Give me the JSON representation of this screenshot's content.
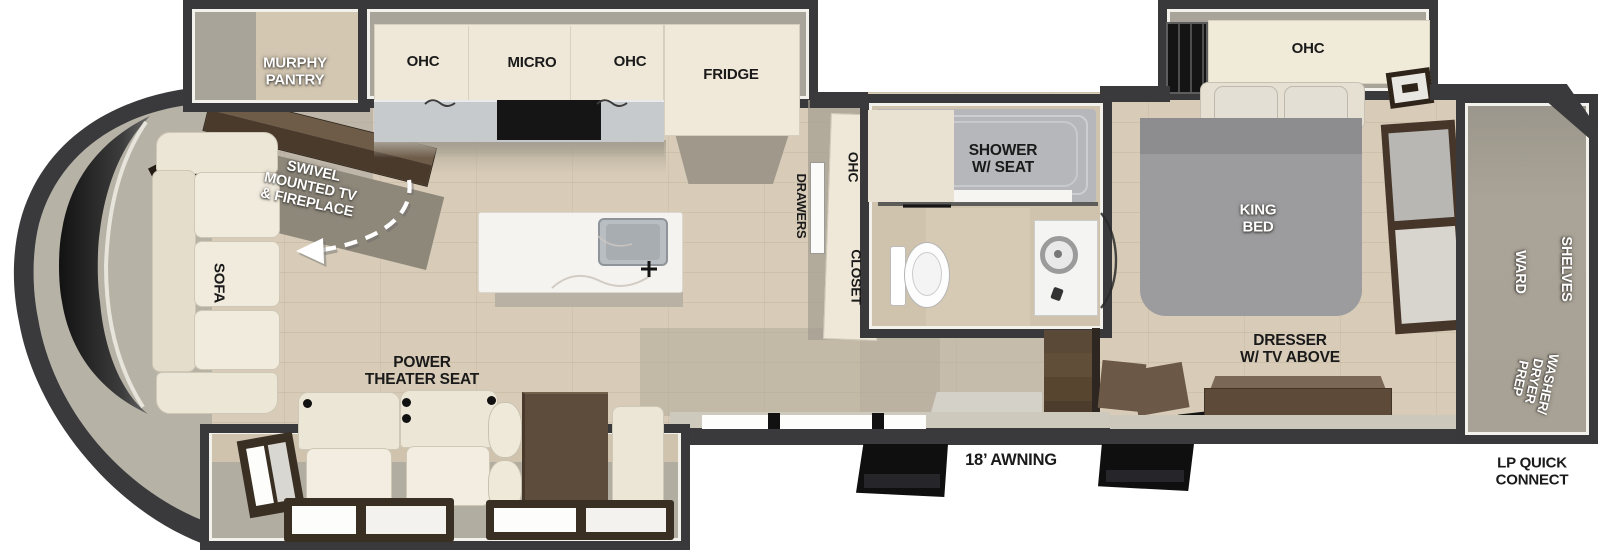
{
  "scene": {
    "type": "rv-floorplan-top-view"
  },
  "labels": {
    "murphy_pantry": "MURPHY\nPANTRY",
    "swivel_tv": "SWIVEL\nMOUNTED TV\n& FIREPLACE",
    "sofa": "SOFA",
    "ohc_kitchen_left": "OHC",
    "micro": "MICRO",
    "ohc_kitchen_right": "OHC",
    "fridge": "FRIDGE",
    "drawers": "DRAWERS",
    "ohc_hall": "OHC",
    "closet": "CLOSET",
    "shower": "SHOWER\nW/ SEAT",
    "ohc_bedroom": "OHC",
    "king_bed": "KING\nBED",
    "dresser": "DRESSER\nW/ TV ABOVE",
    "shelves": "SHELVES",
    "ward": "WARD",
    "washer_dryer_prep": "WASHER/\nDRYER\nPREP",
    "power_theater_seat": "POWER\nTHEATER SEAT",
    "awning": "18’ AWNING",
    "lp_quick_connect": "LP QUICK\nCONNECT"
  },
  "colors": {
    "wall_dark": "#3a3a3c",
    "interior_wall": "#a9a49a",
    "floor_wood": "#d8ccb8",
    "cabinet_cream": "#efe8d8",
    "counter_gray": "#c7cacd",
    "furniture_brown": "#5d4a39",
    "bed_gray": "#9c9c9e",
    "label_black": "#1a1a1a",
    "label_white": "#ffffff"
  }
}
